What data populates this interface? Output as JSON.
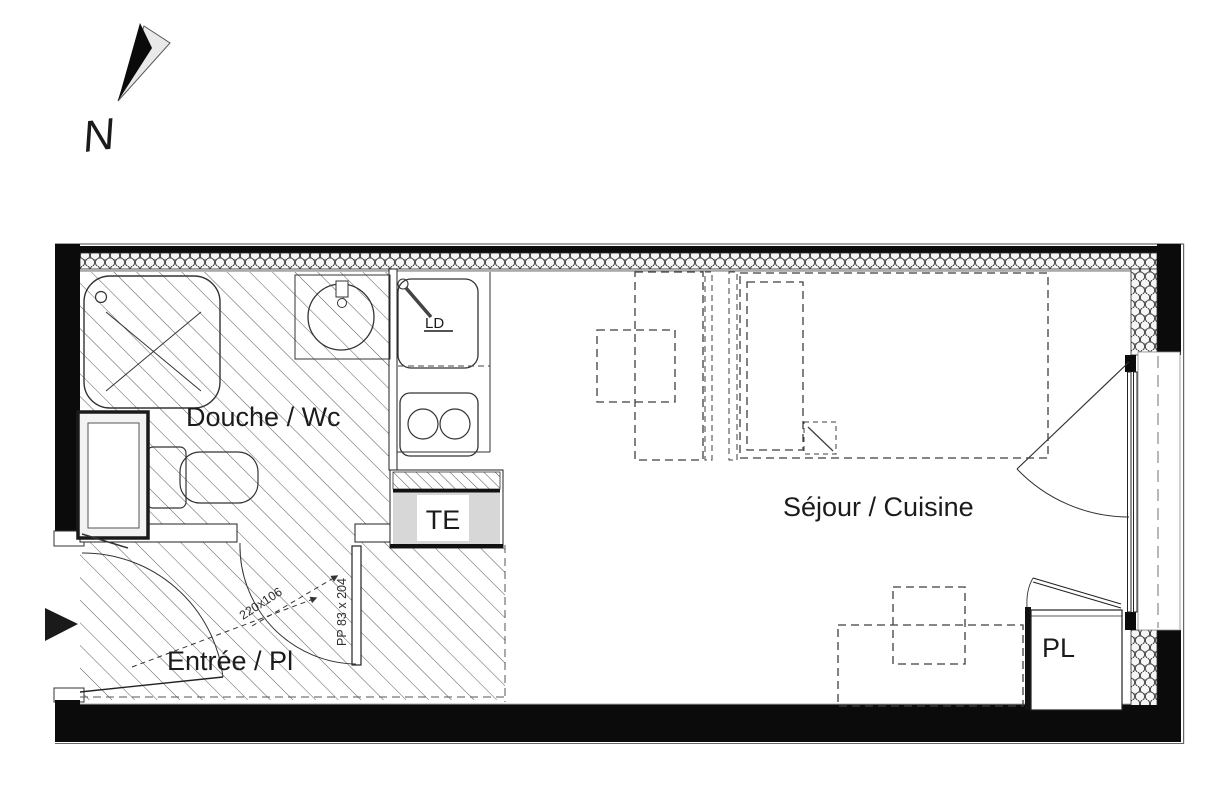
{
  "plan": {
    "north": "N",
    "rooms": {
      "bathroom": "Douche / Wc",
      "living": "Séjour / Cuisine",
      "entry": "Entrée / Pl"
    },
    "fixtures": {
      "electrical_panel": "TE",
      "closet": "PL",
      "sink_unit": "LD"
    },
    "dimensions": {
      "entry_door": "220x106",
      "bathroom_door": "PP 83 x 204"
    },
    "colors": {
      "wall": "#000000",
      "line": "#333333",
      "panel_fill": "#d7d7d7",
      "insulation_fill": "#ededed",
      "background": "#ffffff"
    }
  }
}
